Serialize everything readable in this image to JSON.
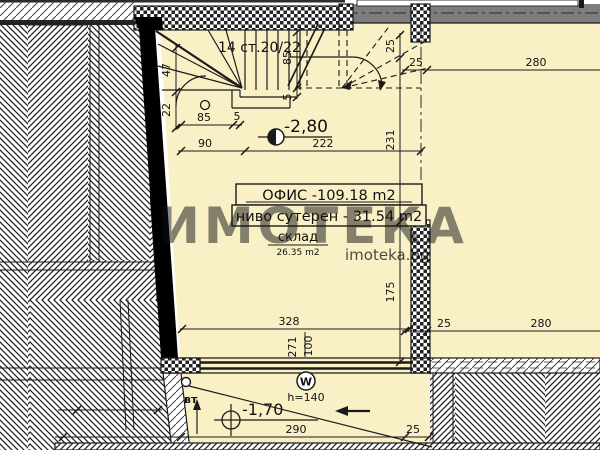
{
  "plan": {
    "stair_label": "14 ст.20/22",
    "level_upper": "-2,80",
    "office_box": {
      "line1": "ОФИС -109.18 m2",
      "line2": "ниво сутерен - 31.54 m2"
    },
    "storage": {
      "name": "склад",
      "area": "26.35 m2"
    },
    "garage": {
      "vt_label": "вт",
      "level": "-1,70",
      "window_mark": "W",
      "window_sill": "h=140"
    },
    "watermark": {
      "big": "ИМОТЕКА",
      "small": "imoteka.bg"
    },
    "colors": {
      "room_fill": "#faf0c6",
      "wall_gray": "#7d7d7d",
      "line": "#1a1a1a",
      "paper": "#ffffff"
    },
    "dimensions": {
      "stair_left_v": [
        "47",
        "22"
      ],
      "stair_left_h1": [
        "85",
        "5"
      ],
      "stair_left_h2": [
        "90",
        "222"
      ],
      "stair_mid_v": [
        "85",
        "5"
      ],
      "axis_chain_v": [
        "25",
        "231",
        "175"
      ],
      "top_right_h": [
        "25",
        "280"
      ],
      "mid_right_h": [
        "25",
        "280"
      ],
      "room_width_h": "328",
      "window_v": [
        "271",
        "100"
      ],
      "bottom_h": [
        "290",
        "25"
      ]
    }
  }
}
